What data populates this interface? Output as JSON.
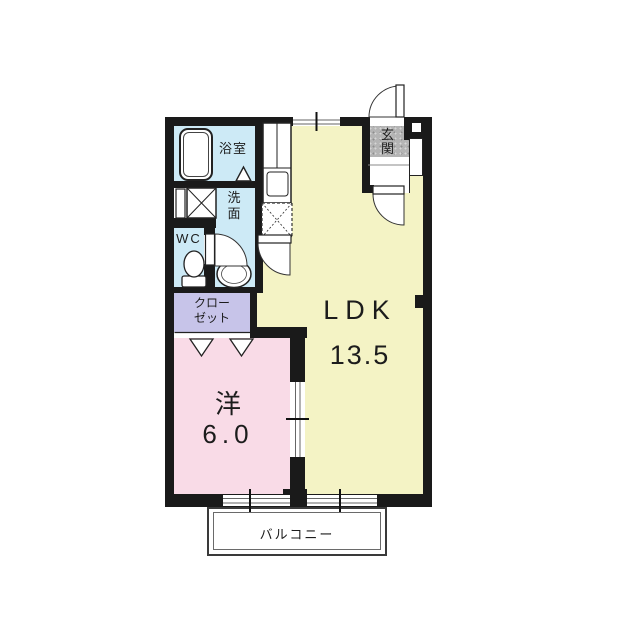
{
  "plan": {
    "type": "apartment-floorplan-1LDK",
    "rooms": {
      "ldk": {
        "label": "LDK",
        "size": "13.5"
      },
      "western": {
        "label": "洋",
        "size": "6.0"
      },
      "bathroom": {
        "label": "浴室"
      },
      "washroom": {
        "label": "洗面",
        "lines": [
          "洗",
          "面"
        ]
      },
      "wc": {
        "label": "WC"
      },
      "genkan": {
        "label": "玄関",
        "lines": [
          "玄",
          "関"
        ]
      },
      "closet": {
        "label": "クローゼット",
        "lines": [
          "クロー",
          "ゼット"
        ]
      },
      "balcony": {
        "label": "バルコニー"
      }
    },
    "colors": {
      "ldk_floor": "#f4f3c5",
      "western_room_floor": "#f9dbe7",
      "water_rooms_floor": "#cdeaf6",
      "closet_floor": "#c7c4e9",
      "genkan_floor": "#b4b4b4",
      "wall": "#1a1a1a",
      "background": "#ffffff"
    }
  }
}
